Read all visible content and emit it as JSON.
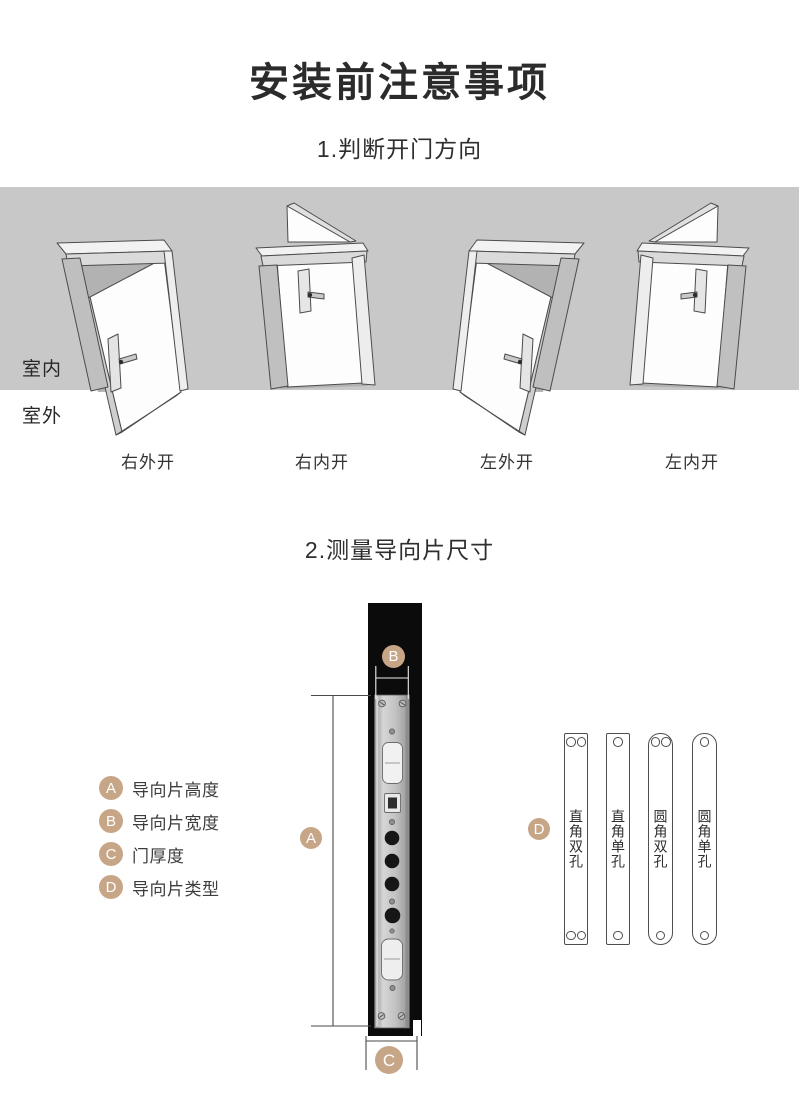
{
  "title": "安装前注意事项",
  "section1": {
    "heading": "1.判断开门方向",
    "indoor_label": "室内",
    "outdoor_label": "室外",
    "doors": [
      {
        "label": "右外开",
        "type": "right-outward"
      },
      {
        "label": "右内开",
        "type": "right-inward"
      },
      {
        "label": "左外开",
        "type": "left-outward"
      },
      {
        "label": "左内开",
        "type": "left-inward"
      }
    ]
  },
  "section2": {
    "heading": "2.测量导向片尺寸",
    "legend": [
      {
        "key": "A",
        "label": "导向片高度"
      },
      {
        "key": "B",
        "label": "导向片宽度"
      },
      {
        "key": "C",
        "label": "门厚度"
      },
      {
        "key": "D",
        "label": "导向片类型"
      }
    ],
    "plates": [
      {
        "label": "直角双孔",
        "corner": "square",
        "holes": "double"
      },
      {
        "label": "直角单孔",
        "corner": "square",
        "holes": "single"
      },
      {
        "label": "圆角双孔",
        "corner": "round",
        "holes": "double"
      },
      {
        "label": "圆角单孔",
        "corner": "round",
        "holes": "single"
      }
    ]
  },
  "colors": {
    "marker_circle": "#c7a688",
    "band_background": "#c8c8c8"
  }
}
